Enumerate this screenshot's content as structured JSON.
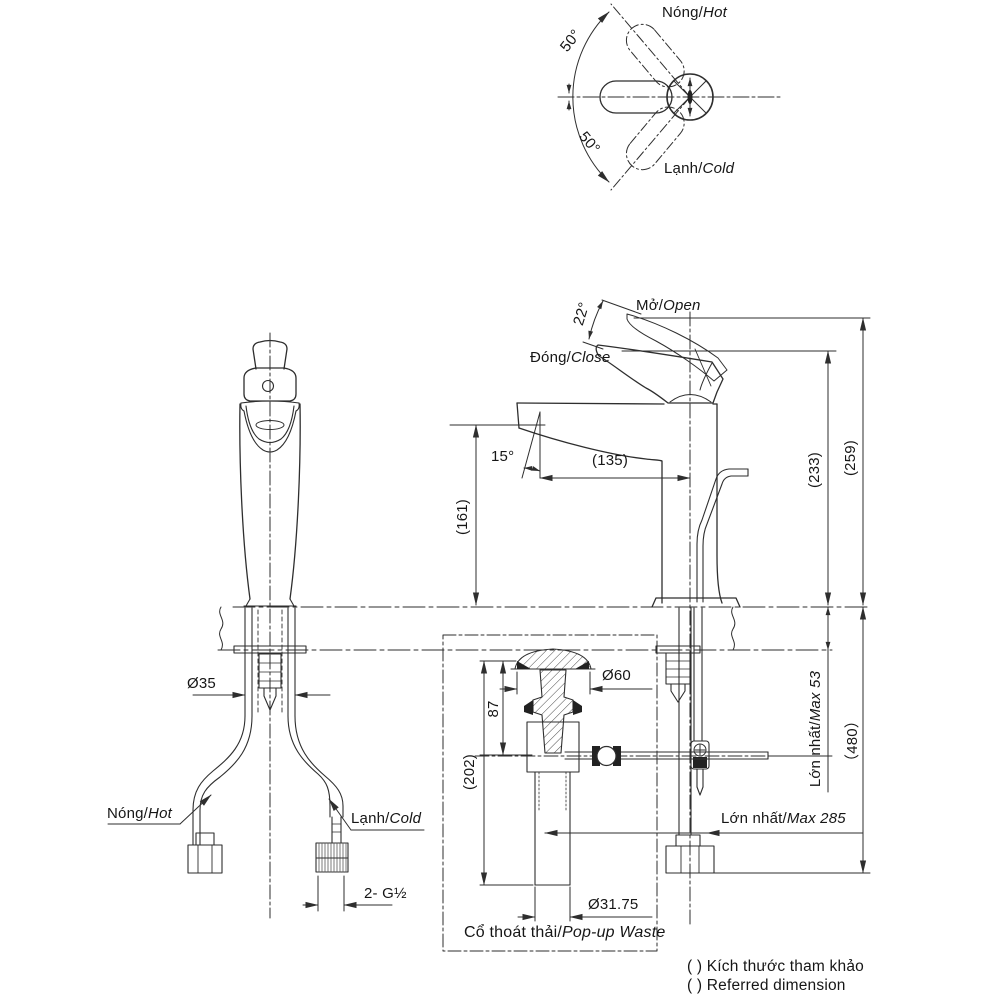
{
  "top_view": {
    "hot": {
      "vi": "Nóng/",
      "en": "Hot"
    },
    "cold": {
      "vi": "Lạnh/",
      "en": "Cold"
    },
    "angle_top": "50°",
    "angle_bottom": "50°"
  },
  "side_view": {
    "open": {
      "vi": "Mở/",
      "en": "Open"
    },
    "close": {
      "vi": "Đóng/",
      "en": "Close"
    },
    "open_angle": "22°",
    "spout_angle": "15°",
    "dim_spout_reach": "(135)",
    "dim_spout_height": "(161)",
    "dim_height_closed": "(233)",
    "dim_height_open": "(259)"
  },
  "below_counter": {
    "dim_hole": "Ø35",
    "max_deck": {
      "vi": "Lớn nhất/",
      "en": "Max 53"
    },
    "dim_overall": "（480）",
    "max_reach": {
      "vi": "Lớn nhất/",
      "en": "Max 285"
    },
    "hot": {
      "vi": "Nóng/",
      "en": "Hot"
    },
    "cold": {
      "vi": "Lạnh/",
      "en": "Cold"
    },
    "thread": "2- G½"
  },
  "popup_waste": {
    "title": {
      "vi": "Cổ thoát thải/",
      "en": "Pop-up Waste"
    },
    "dim_cap": "Ø60",
    "dim_depth": "87",
    "dim_length": "(202)",
    "dim_pipe": "Ø31.75"
  },
  "legend": {
    "vi": "( ) Kích thước tham khảo",
    "en": "( ) Referred dimension"
  },
  "colors": {
    "line": "#2e2e2e",
    "text": "#161616",
    "background": "#ffffff"
  }
}
